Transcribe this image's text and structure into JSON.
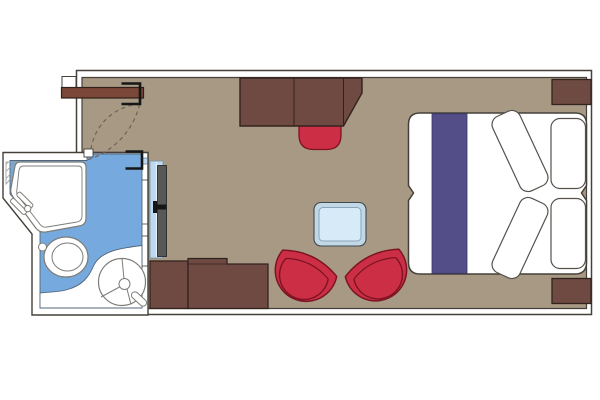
{
  "canvas": {
    "width": 600,
    "height": 400,
    "background": "#ffffff"
  },
  "plan": {
    "type": "cabin-floor-plan",
    "rooms": [
      "cabin",
      "bathroom",
      "entry-corridor"
    ],
    "items": [
      "entrance-door",
      "entrance-door-swing-arc",
      "entrance-door-hinge-bracket",
      "bathroom-door-swing-arc",
      "bathroom-door-hinge-bracket",
      "desk-cabinet",
      "desk-stool",
      "nightstand-top",
      "nightstand-bottom",
      "double-bed",
      "bed-runner",
      "duvet-pillow-upper",
      "duvet-pillow-lower",
      "headboard-pillow-top",
      "headboard-pillow-bottom",
      "coffee-table",
      "armchair-left",
      "armchair-right",
      "dresser-left",
      "dresser-right",
      "shower-tray",
      "shower-faucet",
      "corner-shelf-hatch",
      "toilet",
      "flush-button",
      "sink-counter",
      "sink",
      "sink-faucet",
      "bathroom-wall",
      "bathroom-glass-panel",
      "bathroom-sliding-door",
      "bathroom-door-handle"
    ]
  },
  "colors": {
    "white": "#ffffff",
    "wall_line": "#45403a",
    "floor": "#a79983",
    "furniture": "#6e4a43",
    "furniture_dark": "#33231e",
    "door_wood": "#7a4738",
    "red": "#cc2f45",
    "red_dark": "#7d1322",
    "purple": "#534e87",
    "purple_dark": "#3a366b",
    "bath_floor": "#76aade",
    "bath_line": "#54657a",
    "glass": "#bdd9f2",
    "glass_line": "#7a93a8",
    "table_frame": "#c3d8e6",
    "table_top": "#d6eaf8",
    "table_line": "#8aa5b8",
    "fixture_line": "#7c7c78",
    "door_panel_gray": "#585858",
    "black": "#161616",
    "arc": "#6f6257",
    "hatch": "#9a9a9a",
    "pillow_line": "#55524c"
  }
}
